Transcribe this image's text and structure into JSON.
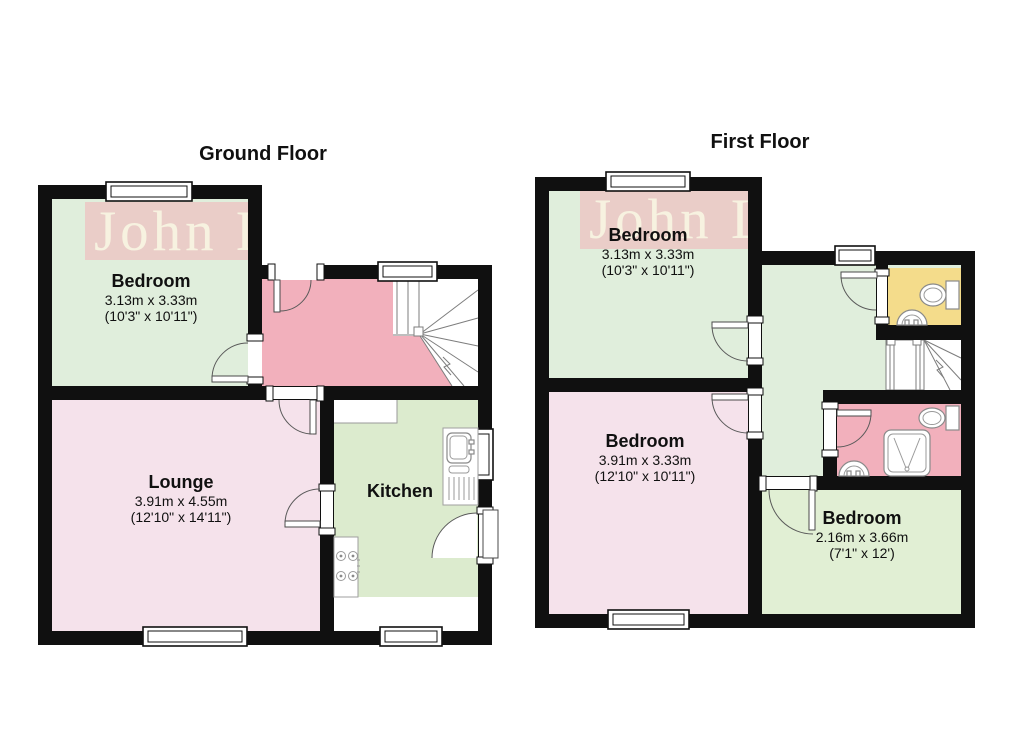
{
  "watermark": {
    "text": "John L",
    "box_color": "#ebc8c5",
    "text_color": "#f8f4e2"
  },
  "palette": {
    "wall": "#101010",
    "bedroom_green": "#e0eedc",
    "kitchen_green": "#dcebce",
    "small_bedroom_green": "#e1efd4",
    "pale_pink": "#f5e2eb",
    "hall_pink": "#f2b0bc",
    "bathroom_pink": "#f2b0bc",
    "wc_yellow": "#f4dc8b"
  },
  "ground_floor": {
    "title": "Ground Floor",
    "rooms": [
      {
        "name": "Bedroom",
        "metric": "3.13m x 3.33m",
        "imperial": "(10'3\" x 10'11\")"
      },
      {
        "name": "Lounge",
        "metric": "3.91m x 4.55m",
        "imperial": "(12'10\" x 14'11\")"
      },
      {
        "name": "Kitchen"
      }
    ]
  },
  "first_floor": {
    "title": "First Floor",
    "rooms": [
      {
        "name": "Bedroom",
        "metric": "3.13m x 3.33m",
        "imperial": "(10'3\" x 10'11\")"
      },
      {
        "name": "Bedroom",
        "metric": "3.91m x 3.33m",
        "imperial": "(12'10\" x 10'11\")"
      },
      {
        "name": "Bedroom",
        "metric": "2.16m x 3.66m",
        "imperial": "(7'1\" x 12')"
      }
    ]
  }
}
